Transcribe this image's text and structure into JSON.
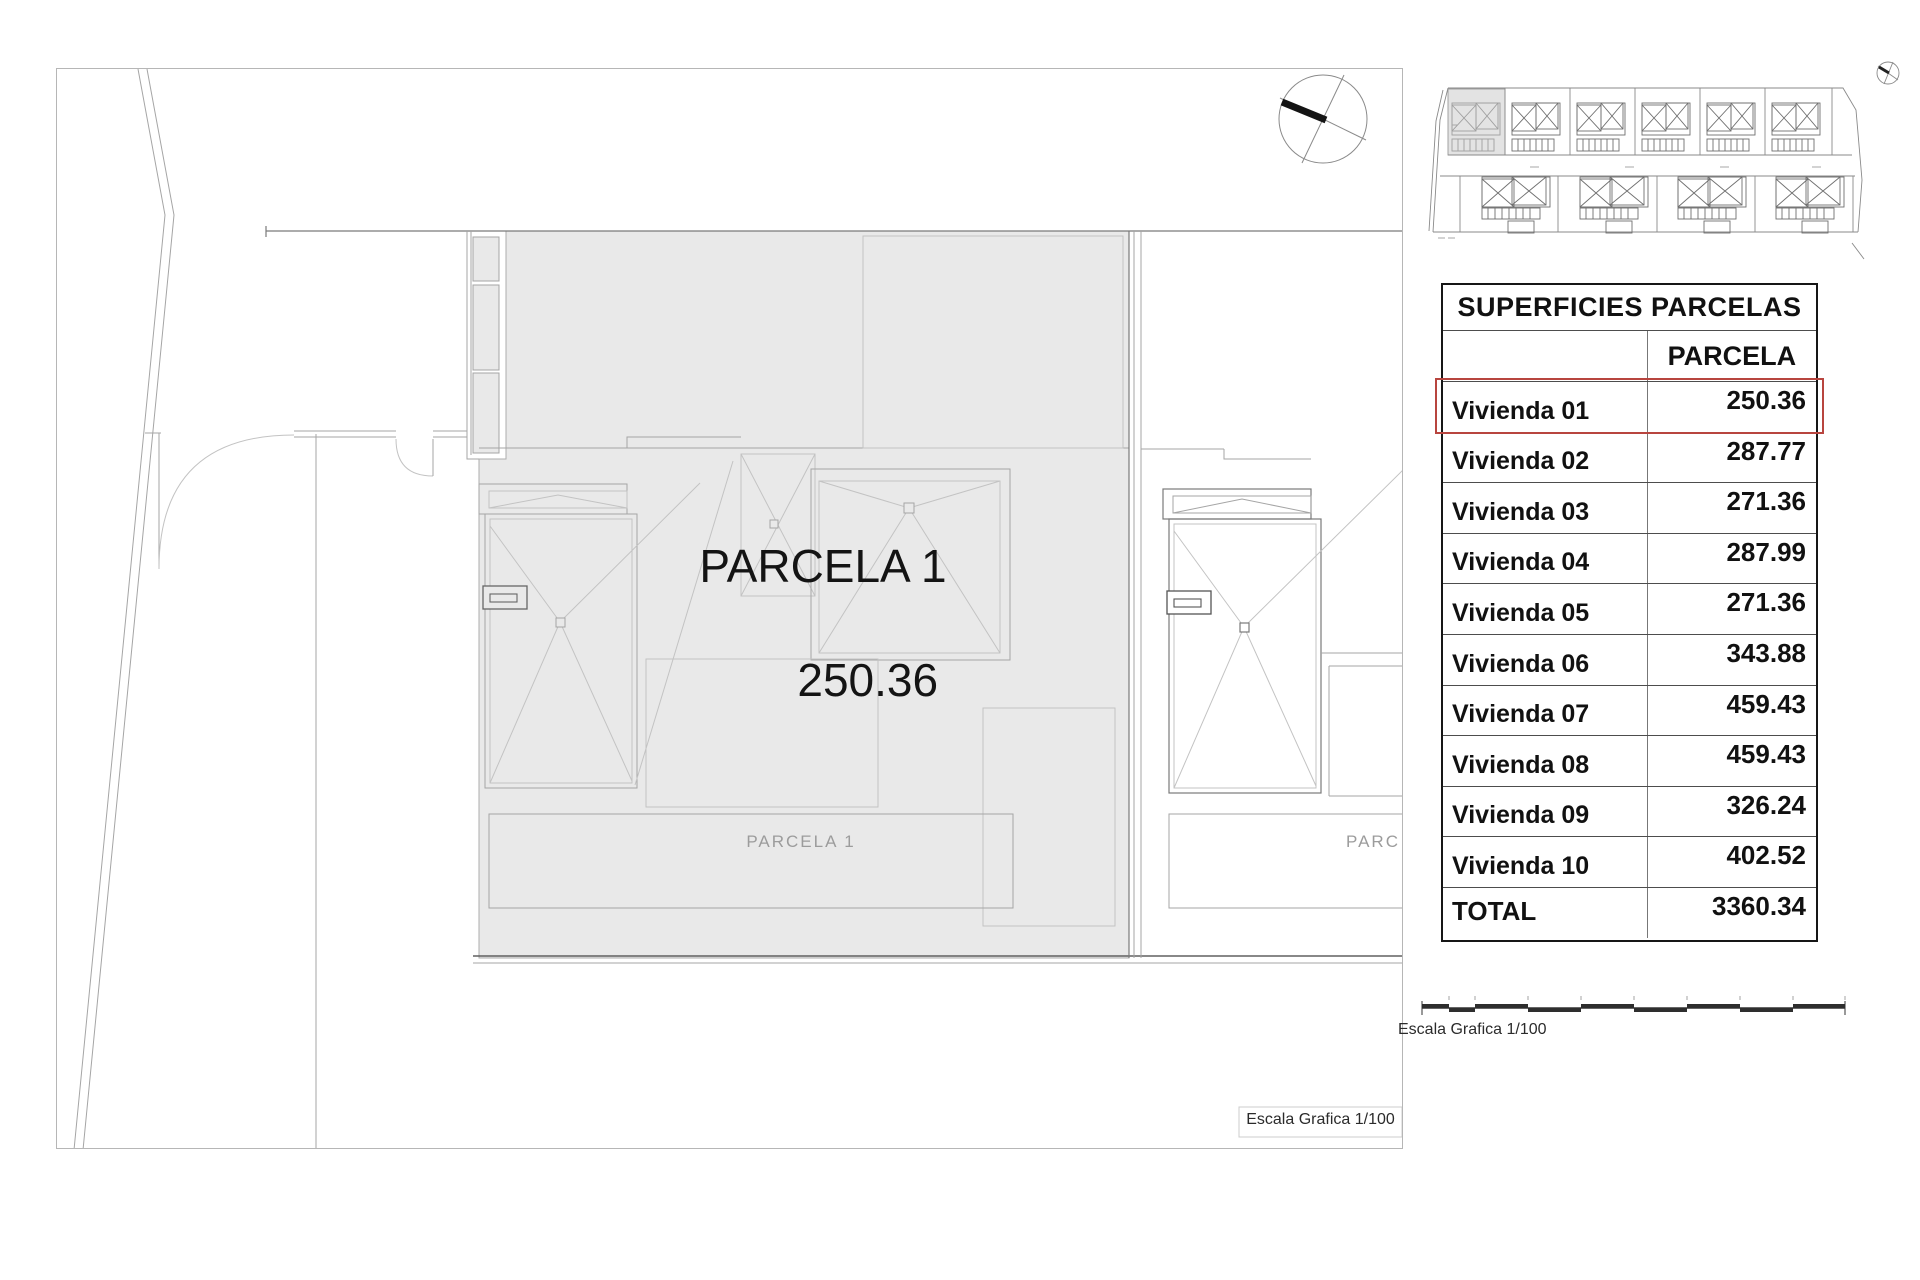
{
  "drawing": {
    "parcel_title": "PARCELA 1",
    "parcel_area": "250.36",
    "terrace_label": "PARCELA 1",
    "neighbor_terrace_label": "PARC",
    "scale_box_label": "Escala Grafica 1/100"
  },
  "scale_bar": {
    "label": "Escala Grafica 1/100"
  },
  "surfaces_table": {
    "title": "SUPERFICIES PARCELAS",
    "column_header": "PARCELA",
    "rows": [
      {
        "label": "Vivienda 01",
        "value": "250.36"
      },
      {
        "label": "Vivienda 02",
        "value": "287.77"
      },
      {
        "label": "Vivienda 03",
        "value": "271.36"
      },
      {
        "label": "Vivienda 04",
        "value": "287.99"
      },
      {
        "label": "Vivienda 05",
        "value": "271.36"
      },
      {
        "label": "Vivienda 06",
        "value": "343.88"
      },
      {
        "label": "Vivienda 07",
        "value": "459.43"
      },
      {
        "label": "Vivienda 08",
        "value": "459.43"
      },
      {
        "label": "Vivienda 09",
        "value": "326.24"
      },
      {
        "label": "Vivienda 10",
        "value": "402.52"
      }
    ],
    "total": {
      "label": "TOTAL",
      "value": "3360.34"
    },
    "highlighted_row_index": 0
  },
  "colors": {
    "parcel_fill": "#e9e9e9",
    "highlight_red": "#b8453f",
    "map_highlight_fill": "#e3e3e3"
  }
}
